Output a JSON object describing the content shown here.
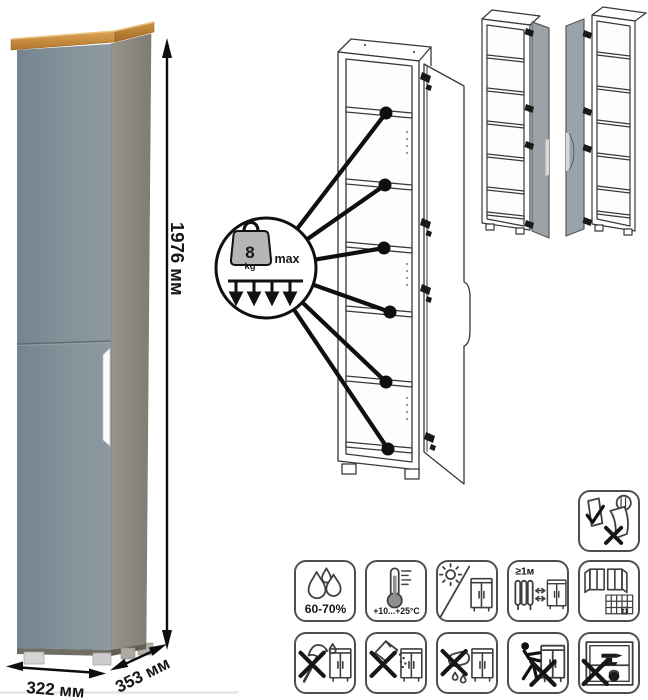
{
  "product": {
    "dimensions": {
      "height": "1976 мм",
      "width": "322 мм",
      "depth": "353 мм"
    }
  },
  "shelf_load": {
    "value": "8",
    "unit": "kg",
    "qualifier": "max"
  },
  "care": {
    "humidity": "60-70%",
    "temperature": "+10...+25°C",
    "heat_distance": "≥1м",
    "calendar_day": "21",
    "icons": [
      {
        "name": "humidity",
        "label": "60-70%"
      },
      {
        "name": "temperature-range",
        "label": "+10...+25°C"
      },
      {
        "name": "no-direct-sunlight",
        "label": ""
      },
      {
        "name": "keep-1m-from-heat",
        "label": "≥1м"
      },
      {
        "name": "ventilation-calendar",
        "label": "21"
      },
      {
        "name": "no-sharp-tools",
        "label": ""
      },
      {
        "name": "no-abrasive-cleaners",
        "label": ""
      },
      {
        "name": "no-wet-cleaning",
        "label": ""
      },
      {
        "name": "no-pushing-when-loaded",
        "label": ""
      },
      {
        "name": "no-overloading",
        "label": ""
      },
      {
        "name": "check-door-alignment",
        "label": ""
      }
    ]
  },
  "colors": {
    "door_front": "#82909A",
    "side_panel": "#8F8C83",
    "top_board_wood": "#C9893C",
    "handle": "#FFFFFF",
    "line_art": "#3A3A3A"
  }
}
